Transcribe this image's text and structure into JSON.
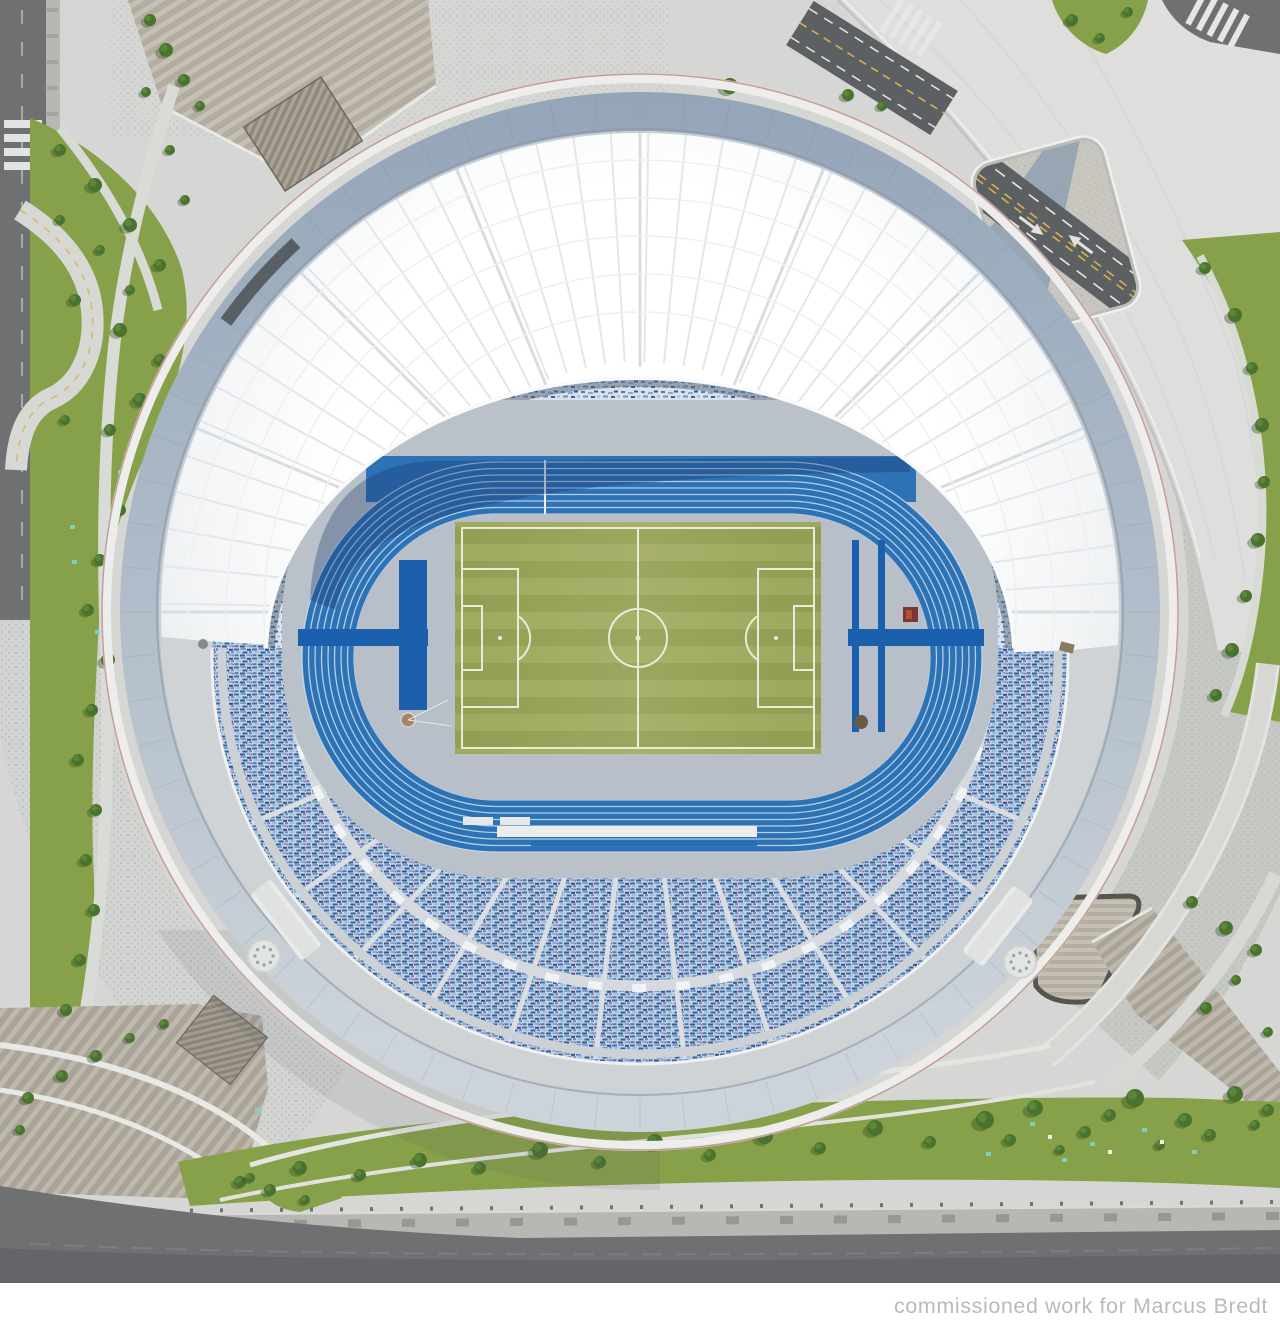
{
  "meta": {
    "kind": "aerial-photograph",
    "description": "Top-down drone photograph of a circular stadium with a white membrane roof, blue running track, green football pitch, blue speckled grandstands, surrounded by plazas, lawns, curved paths and roads."
  },
  "caption": {
    "text": "commissioned work for Marcus Bredt"
  },
  "colors": {
    "page-bg": "#ffffff",
    "plaza": "#d6d7d4",
    "deck": "#dedfdc",
    "rim-top": "#93a5b8",
    "rim-mid": "#aebbc8",
    "rim-bottom": "#cdd3da",
    "roof-white": "#fafbfc",
    "roof-shade": "#e4e7ea",
    "track-blue": "#2e72b6",
    "track-bar": "#1a60ac",
    "lane-line": "#cadeed",
    "infield-gray": "#b8bfc8",
    "grass": "#9da95c",
    "pitch-line": "#e6ecd8",
    "stand-base": "#ccd1d7",
    "concourse": "#bac1c9",
    "road": "#6e7072",
    "road-dark": "#5d6062",
    "sidewalk": "#b7b8b4",
    "grass-field": "#87a04a",
    "tree": "#4a7330",
    "tree-shadow": "#33511f",
    "caption-color": "#b9babc",
    "yellow-line": "#d2b24c",
    "white-mark": "#e9eae7",
    "cyan-dot": "#7fd4cc",
    "red-edge": "#9c5147"
  }
}
